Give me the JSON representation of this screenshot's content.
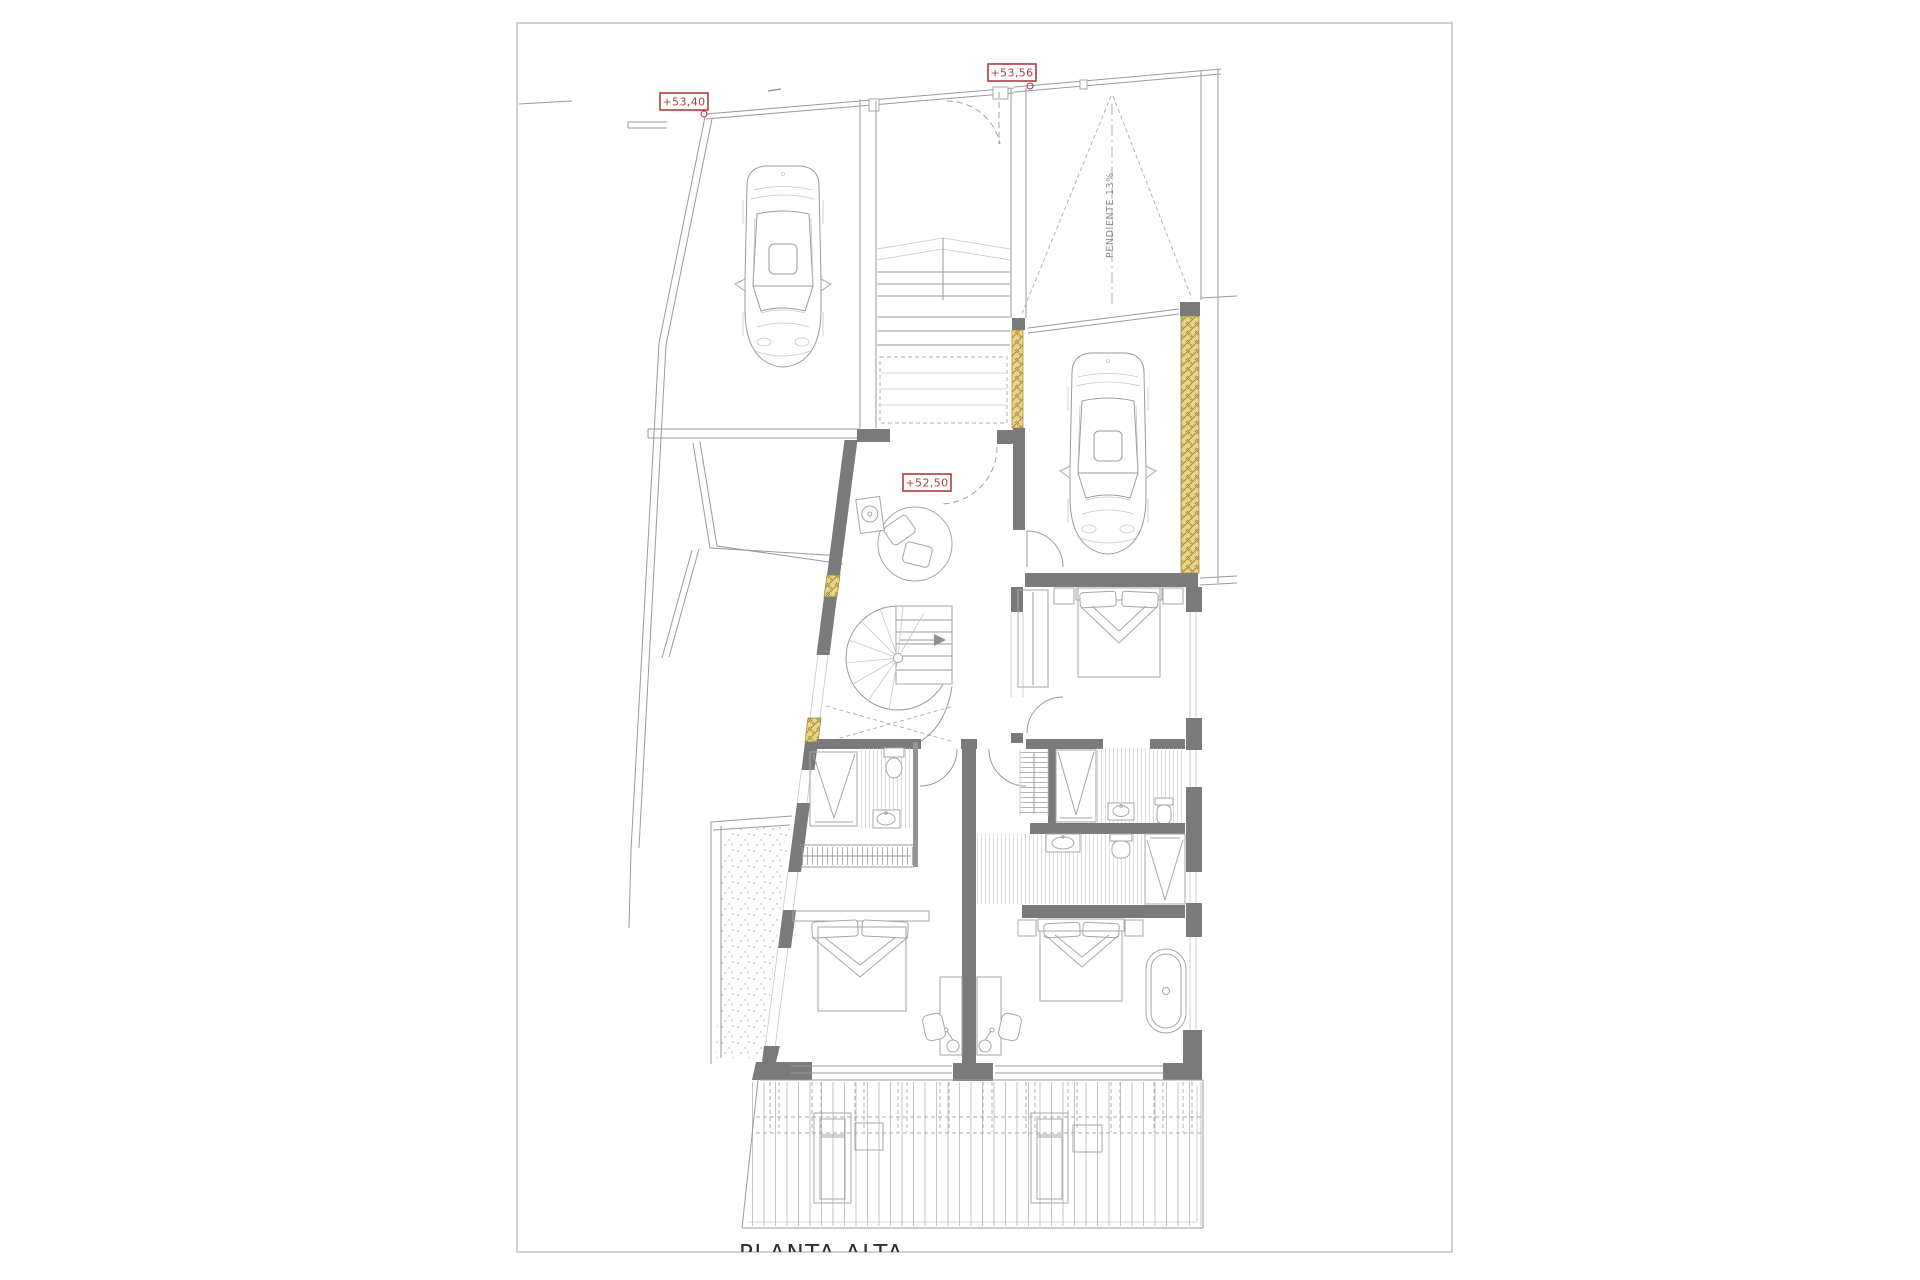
{
  "drawing": {
    "title": "PLANTA ALTA",
    "elevation_labels": [
      {
        "text": "+53,40",
        "location": "street-sidewalk"
      },
      {
        "text": "+53,56",
        "location": "entrance-gate"
      },
      {
        "text": "+52,50",
        "location": "entry-hall"
      }
    ],
    "ramp_label": "PENDIENTE 13%"
  },
  "colors": {
    "paper": "#ffffff",
    "frame": "#c2c2c2",
    "line": "#9a9a9a",
    "wall_fill": "#7a7a7a",
    "window_yellow": "#e9d586",
    "annotation_red": "#b03c3c",
    "text_dark": "#2e2e2e"
  }
}
